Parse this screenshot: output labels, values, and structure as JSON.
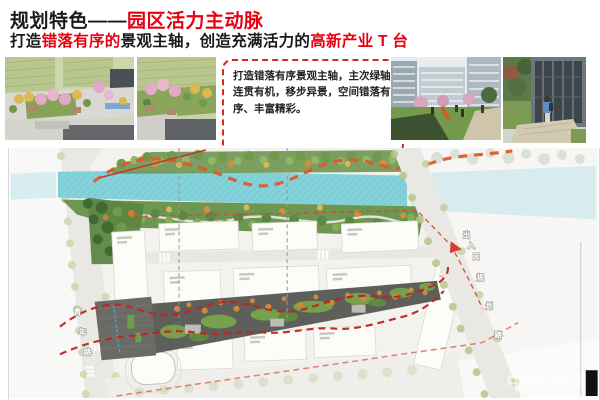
{
  "header": {
    "title_prefix": "规划特色——",
    "title_highlight": "园区活力主动脉",
    "subtitle_part1": "打造",
    "subtitle_red1": "错落有序的",
    "subtitle_part2": "景观主轴，创造充满活力的",
    "subtitle_red2": "高新产业 T 台"
  },
  "callout": {
    "text": "打造错落有序景观主轴，主次绿轴连贯有机，移步异景，空间错落有序、丰富精彩。"
  },
  "masterplan": {
    "road_left_chars": [
      "青",
      "年",
      "路"
    ],
    "road_right_chars": [
      "规",
      "划",
      "路"
    ],
    "entrance_chars": [
      "出",
      "入",
      "口"
    ],
    "watermark": "中",
    "colors": {
      "accent_red": "#e60012",
      "axis_line_red": "#c22420",
      "river_wave_orange": "#e2572b",
      "river_cyan": "#85d2da",
      "boundary_red": "#cf4a3a"
    }
  }
}
